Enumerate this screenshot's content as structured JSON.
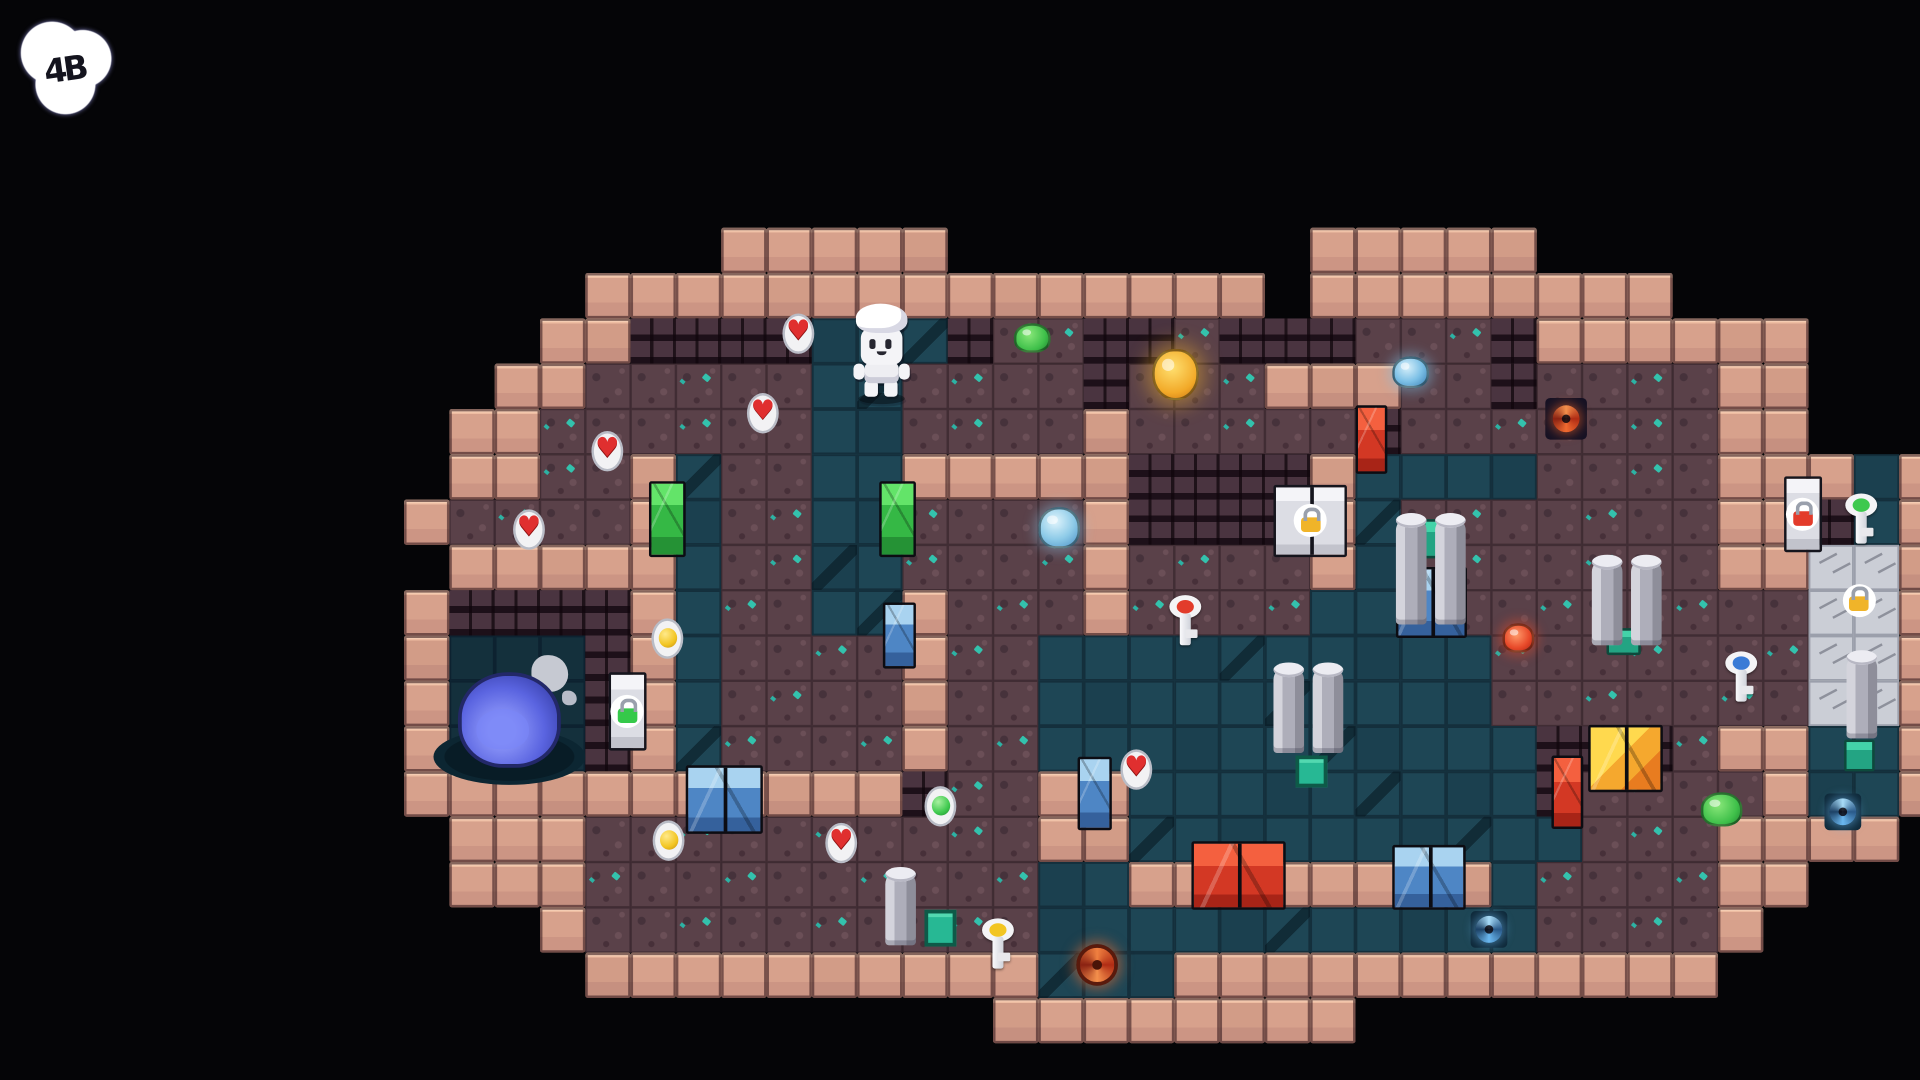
{
  "hud": {
    "bubble_glyphs": "4B"
  },
  "palette": {
    "background": "#050507",
    "wall_pink": "#d7a18c",
    "wall_brick_dark": "#2a1c26",
    "floor_teal": "#1e4655",
    "floor_dirt": "#5a4149",
    "floor_silver": "#cbced6",
    "door_green": "#35b845",
    "door_blue": "#4e86c5",
    "door_red": "#d33824",
    "door_gold": "#f5a82e",
    "door_silver": "#dcdde4",
    "lock_gold": "#f0b429",
    "lock_green": "#35c94a",
    "lock_red": "#e33c2b",
    "slime_blue_boss": "#5a64e0",
    "gem_teal": "#2fd0b8",
    "heart_red": "#e02f2f"
  },
  "icons": {
    "heart": "♥"
  },
  "map": {
    "origin_x": 330,
    "origin_y": 186,
    "tile": 37,
    "legend": {
      " ": "void",
      "W": "pink-wall",
      "B": "dark-brick",
      "d": "dirt-floor",
      "f": "teal-floor",
      "p": "pool-floor",
      "w": "silver-floor"
    },
    "rows": [
      ".......WWWWW........WWWWW.........",
      "....WWWWWWWWWWWWWWW.WWWWWWWW......",
      "...WWBBBBfffBddBBdBBBdddBWWWWWW...",
      "..WWdddddffddddBdddWWWddBddddWW...",
      ".WWddddddffddddWdddddBdddddddWW...",
      ".WWddWfddffWWWWWBBBBWffffddddWWWfW",
      "WddddWfddffddddWBBBBWfdddddddWWBfW",
      ".WWWWWfddffddddWddddWfdddddddWWwwW",
      "WBBBBWfddffWdddWddddffdddddddddwwW",
      "WpppBWfddddWddffffffffffdddddddwwW",
      "WpppBWfddddWddffffffffffdddddddwwW",
      "WpppBWfddddWddfffffffffffBBBdWWffW",
      "WWWWWWWWWWWBddWWfffffffffBddddWffW",
      ".WWWddddddddddWWffffffffffdddWWWW.",
      ".WWWddddddddddffWWWWWWWWfddddWW...",
      "...WddddddddddfffffffffffddddW....",
      "....WWWWWWWWWWfffWWWWWWWWWWWW.....",
      ".............WWWWWWWW............."
    ]
  },
  "entities": [
    {
      "name": "slime-pool",
      "type": "pool",
      "cx": 416,
      "cy": 618,
      "w": 124,
      "h": 46
    },
    {
      "name": "splash-decor",
      "type": "splash",
      "cx": 448,
      "cy": 550,
      "w": 64,
      "h": 54
    },
    {
      "name": "big-blue-slime",
      "type": "bigslime",
      "cx": 416,
      "cy": 588,
      "w": 84,
      "h": 78
    },
    {
      "name": "green-door-west",
      "type": "door",
      "color": "green",
      "cx": 545,
      "cy": 424,
      "w": 30,
      "h": 62
    },
    {
      "name": "green-door-mid",
      "type": "door",
      "color": "green",
      "cx": 733,
      "cy": 424,
      "w": 30,
      "h": 62
    },
    {
      "name": "blue-door-upper",
      "type": "door",
      "color": "blue",
      "cx": 734,
      "cy": 519,
      "w": 27,
      "h": 54
    },
    {
      "name": "blue-door-mid",
      "type": "door",
      "color": "blue",
      "cx": 894,
      "cy": 648,
      "w": 28,
      "h": 60
    },
    {
      "name": "blue-double-door-southwest",
      "type": "door",
      "color": "blue",
      "dbl": true,
      "cx": 591,
      "cy": 653,
      "w": 63,
      "h": 56
    },
    {
      "name": "blue-double-door-south",
      "type": "door",
      "color": "blue",
      "dbl": true,
      "cx": 1167,
      "cy": 716,
      "w": 60,
      "h": 53
    },
    {
      "name": "blue-double-door-east",
      "type": "door",
      "color": "blue",
      "dbl": true,
      "cx": 1169,
      "cy": 492,
      "w": 58,
      "h": 58
    },
    {
      "name": "red-door-north",
      "type": "door",
      "color": "red",
      "cx": 1120,
      "cy": 359,
      "w": 26,
      "h": 56
    },
    {
      "name": "red-door-east",
      "type": "door",
      "color": "red",
      "cx": 1280,
      "cy": 647,
      "w": 26,
      "h": 60
    },
    {
      "name": "red-double-door-south",
      "type": "door",
      "color": "red",
      "dbl": true,
      "cx": 1011,
      "cy": 715,
      "w": 77,
      "h": 56
    },
    {
      "name": "gold-double-door",
      "type": "door",
      "color": "gold",
      "dbl": true,
      "cx": 1327,
      "cy": 619,
      "w": 61,
      "h": 55
    },
    {
      "name": "silver-locked-door-gold",
      "type": "lockdoor",
      "lock": "goldlock",
      "dbl": true,
      "cx": 1070,
      "cy": 425,
      "w": 60,
      "h": 59
    },
    {
      "name": "locked-door-green",
      "type": "lockdoor",
      "lock": "greenlock",
      "cx": 512,
      "cy": 581,
      "w": 31,
      "h": 64
    },
    {
      "name": "locked-door-red",
      "type": "lockdoor",
      "lock": "redlock",
      "cx": 1472,
      "cy": 420,
      "w": 31,
      "h": 62
    },
    {
      "name": "gold-lock-gate",
      "type": "lock",
      "lock": "goldlock",
      "cx": 1518,
      "cy": 490,
      "w": 27,
      "h": 27
    },
    {
      "name": "teal-gate-1",
      "type": "tealdoor",
      "cx": 1170,
      "cy": 440,
      "w": 17,
      "h": 32
    },
    {
      "name": "teal-gate-2",
      "type": "tealdoor",
      "cx": 1326,
      "cy": 524,
      "w": 28,
      "h": 22
    },
    {
      "name": "teal-gate-3",
      "type": "tealdoor",
      "cx": 1518,
      "cy": 617,
      "w": 25,
      "h": 26
    },
    {
      "name": "pillar-pair-east-north",
      "type": "pillars",
      "cx": 1168,
      "cy": 466,
      "w": 57,
      "h": 87
    },
    {
      "name": "pillar-pair-east",
      "type": "pillars",
      "cx": 1328,
      "cy": 492,
      "w": 57,
      "h": 70
    },
    {
      "name": "pillar-pair-center",
      "type": "pillars",
      "cx": 1068,
      "cy": 580,
      "w": 57,
      "h": 70
    },
    {
      "name": "pillar-single-south",
      "type": "pillar",
      "cx": 735,
      "cy": 742,
      "w": 25,
      "h": 60
    },
    {
      "name": "pillar-single-east",
      "type": "pillar",
      "cx": 1520,
      "cy": 569,
      "w": 25,
      "h": 68
    },
    {
      "name": "emerald-panel-1",
      "type": "panel",
      "cx": 1071,
      "cy": 630,
      "w": 26,
      "h": 26
    },
    {
      "name": "emerald-panel-2",
      "type": "panel",
      "cx": 768,
      "cy": 758,
      "w": 26,
      "h": 30
    },
    {
      "name": "portal-red",
      "type": "portal",
      "color": "red",
      "cx": 1279,
      "cy": 342,
      "w": 34,
      "h": 34
    },
    {
      "name": "portal-blue-south",
      "type": "portal",
      "color": "blue",
      "cx": 1216,
      "cy": 759,
      "w": 30,
      "h": 30
    },
    {
      "name": "portal-blue-east",
      "type": "portal",
      "color": "blue",
      "cx": 1505,
      "cy": 663,
      "w": 30,
      "h": 30
    },
    {
      "name": "slime-green-1",
      "type": "slime",
      "color": "green",
      "cx": 843,
      "cy": 276,
      "w": 30,
      "h": 24
    },
    {
      "name": "slime-gold",
      "type": "slime",
      "color": "gold",
      "cx": 960,
      "cy": 306,
      "w": 38,
      "h": 42
    },
    {
      "name": "slime-lightblue",
      "type": "slime",
      "color": "lightblue",
      "cx": 865,
      "cy": 431,
      "w": 34,
      "h": 34
    },
    {
      "name": "slime-blue",
      "type": "slime",
      "color": "blue",
      "cx": 1152,
      "cy": 304,
      "w": 30,
      "h": 26
    },
    {
      "name": "slime-green-2",
      "type": "slime",
      "color": "green",
      "cx": 1406,
      "cy": 661,
      "w": 34,
      "h": 28
    },
    {
      "name": "slime-red",
      "type": "slime",
      "color": "red",
      "cx": 1240,
      "cy": 521,
      "w": 26,
      "h": 24
    },
    {
      "name": "orange-swirl-orb",
      "type": "orangeswirl",
      "cx": 896,
      "cy": 788,
      "w": 34,
      "h": 34
    },
    {
      "name": "heart-pickup-1",
      "type": "heart",
      "cx": 652,
      "cy": 272,
      "w": 26,
      "h": 33
    },
    {
      "name": "heart-pickup-2",
      "type": "heart",
      "cx": 623,
      "cy": 337,
      "w": 26,
      "h": 33
    },
    {
      "name": "heart-pickup-3",
      "type": "heart",
      "cx": 496,
      "cy": 368,
      "w": 26,
      "h": 33
    },
    {
      "name": "heart-pickup-4",
      "type": "heart",
      "cx": 432,
      "cy": 432,
      "w": 26,
      "h": 33
    },
    {
      "name": "heart-pickup-5",
      "type": "heart",
      "cx": 928,
      "cy": 628,
      "w": 26,
      "h": 33
    },
    {
      "name": "heart-pickup-6",
      "type": "heart",
      "cx": 687,
      "cy": 688,
      "w": 26,
      "h": 33
    },
    {
      "name": "orb-pickup-yellow-1",
      "type": "orb",
      "color": "yellow",
      "cx": 545,
      "cy": 521,
      "w": 26,
      "h": 33
    },
    {
      "name": "orb-pickup-yellow-2",
      "type": "orb",
      "color": "yellow",
      "cx": 546,
      "cy": 686,
      "w": 26,
      "h": 33
    },
    {
      "name": "orb-pickup-green",
      "type": "orb",
      "color": "green",
      "cx": 768,
      "cy": 658,
      "w": 26,
      "h": 33
    },
    {
      "name": "key-red",
      "type": "key",
      "color": "red",
      "cx": 968,
      "cy": 508,
      "w": 30,
      "h": 44
    },
    {
      "name": "key-yellow",
      "type": "key",
      "color": "yellow",
      "cx": 815,
      "cy": 772,
      "w": 30,
      "h": 44
    },
    {
      "name": "key-green",
      "type": "key",
      "color": "green",
      "cx": 1520,
      "cy": 425,
      "w": 30,
      "h": 44
    },
    {
      "name": "key-blue",
      "type": "key",
      "color": "blue",
      "cx": 1422,
      "cy": 554,
      "w": 30,
      "h": 44
    },
    {
      "name": "player-character",
      "type": "player",
      "cx": 720,
      "cy": 288,
      "w": 46,
      "h": 80
    }
  ]
}
